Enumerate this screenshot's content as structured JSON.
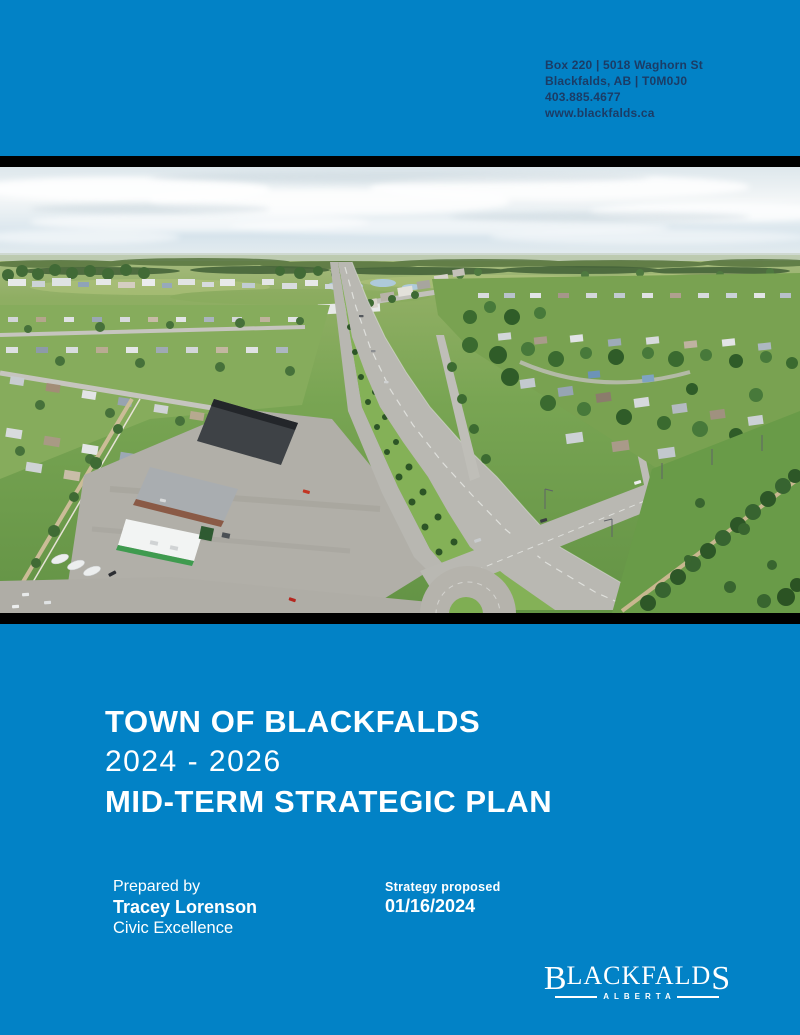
{
  "colors": {
    "background_blue": "#0282c6",
    "divider_black": "#000000",
    "header_text_navy": "#1b3c66",
    "text_white": "#ffffff"
  },
  "header": {
    "address_line1": "Box 220 | 5018 Waghorn St",
    "address_line2": "Blackfalds, AB | T0M0J0",
    "phone": "403.885.4677",
    "website": "www.blackfalds.ca"
  },
  "photo": {
    "description": "Aerial photo of Blackfalds: a highway with a treed median curving toward a crossroads intersection, commercial lots and a gas station on the left, residential neighbourhoods and a park with rows of conifers on the right, under a hazy cloud-streaked sky"
  },
  "title": {
    "line1": "TOWN OF BLACKFALDS",
    "line2": "2024 - 2026",
    "line3": "MID-TERM STRATEGIC PLAN"
  },
  "credits": {
    "prepared_label": "Prepared by",
    "prepared_name": "Tracey Lorenson",
    "prepared_org": "Civic Excellence",
    "proposed_label": "Strategy proposed",
    "proposed_date": "01/16/2024"
  },
  "logo": {
    "name_first": "B",
    "name_middle": "LACKFALD",
    "name_last": "S",
    "tagline": "ALBERTA"
  }
}
